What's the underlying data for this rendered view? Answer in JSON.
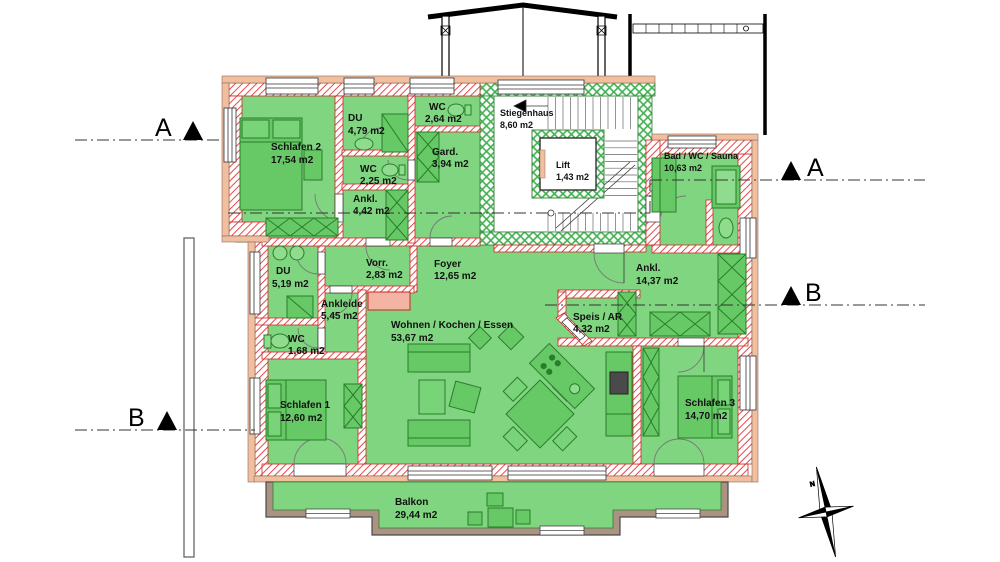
{
  "plan": {
    "rooms": [
      {
        "id": "schlafen-2",
        "name": "Schlafen 2",
        "area": "17,54 m2"
      },
      {
        "id": "du-top",
        "name": "DU",
        "area": "4,79 m2"
      },
      {
        "id": "wc-top",
        "name": "WC",
        "area": "2,64 m2"
      },
      {
        "id": "stiegenhaus",
        "name": "Stiegenhaus",
        "area": "8,60 m2"
      },
      {
        "id": "wc-mid",
        "name": "WC",
        "area": "2,25 m2"
      },
      {
        "id": "garderobe",
        "name": "Gard.",
        "area": "3,94 m2"
      },
      {
        "id": "ankleide-klein",
        "name": "Ankl.",
        "area": "4,42 m2"
      },
      {
        "id": "lift",
        "name": "Lift",
        "area": "1,43 m2"
      },
      {
        "id": "bad-wc-sauna",
        "name": "Bad / WC / Sauna",
        "area": "10,63 m2"
      },
      {
        "id": "du-left",
        "name": "DU",
        "area": "5,19 m2"
      },
      {
        "id": "vorraum",
        "name": "Vorr.",
        "area": "2,83 m2"
      },
      {
        "id": "foyer",
        "name": "Foyer",
        "area": "12,65 m2"
      },
      {
        "id": "ankleide-gross",
        "name": "Ankl.",
        "area": "14,37 m2"
      },
      {
        "id": "ankleide",
        "name": "Ankleide",
        "area": "5,45 m2"
      },
      {
        "id": "wc-klein",
        "name": "WC",
        "area": "1,68 m2"
      },
      {
        "id": "wohnen",
        "name": "Wohnen / Kochen / Essen",
        "area": "53,67 m2"
      },
      {
        "id": "speis",
        "name": "Speis / AR",
        "area": "4,32 m2"
      },
      {
        "id": "schlafen-1",
        "name": "Schlafen 1",
        "area": "12,60 m2"
      },
      {
        "id": "schlafen-3",
        "name": "Schlafen 3",
        "area": "14,70 m2"
      },
      {
        "id": "balkon",
        "name": "Balkon",
        "area": "29,44 m2"
      }
    ],
    "stairs": {
      "step_numbers": [
        "12",
        "11",
        "10",
        "9",
        "8",
        "7"
      ]
    }
  },
  "section_markers": {
    "left_a": "A",
    "right_a": "A",
    "left_b": "B",
    "right_b": "B"
  },
  "compass": {
    "north_label": "N"
  },
  "colors": {
    "room_fill": "#80d680",
    "furniture_fill": "#66c966",
    "wall_hatch_red": "#e84848",
    "wall_hatch_green": "#3faf4f",
    "outer_band": "#f1bf9e",
    "balcony_band": "#ab9383"
  }
}
